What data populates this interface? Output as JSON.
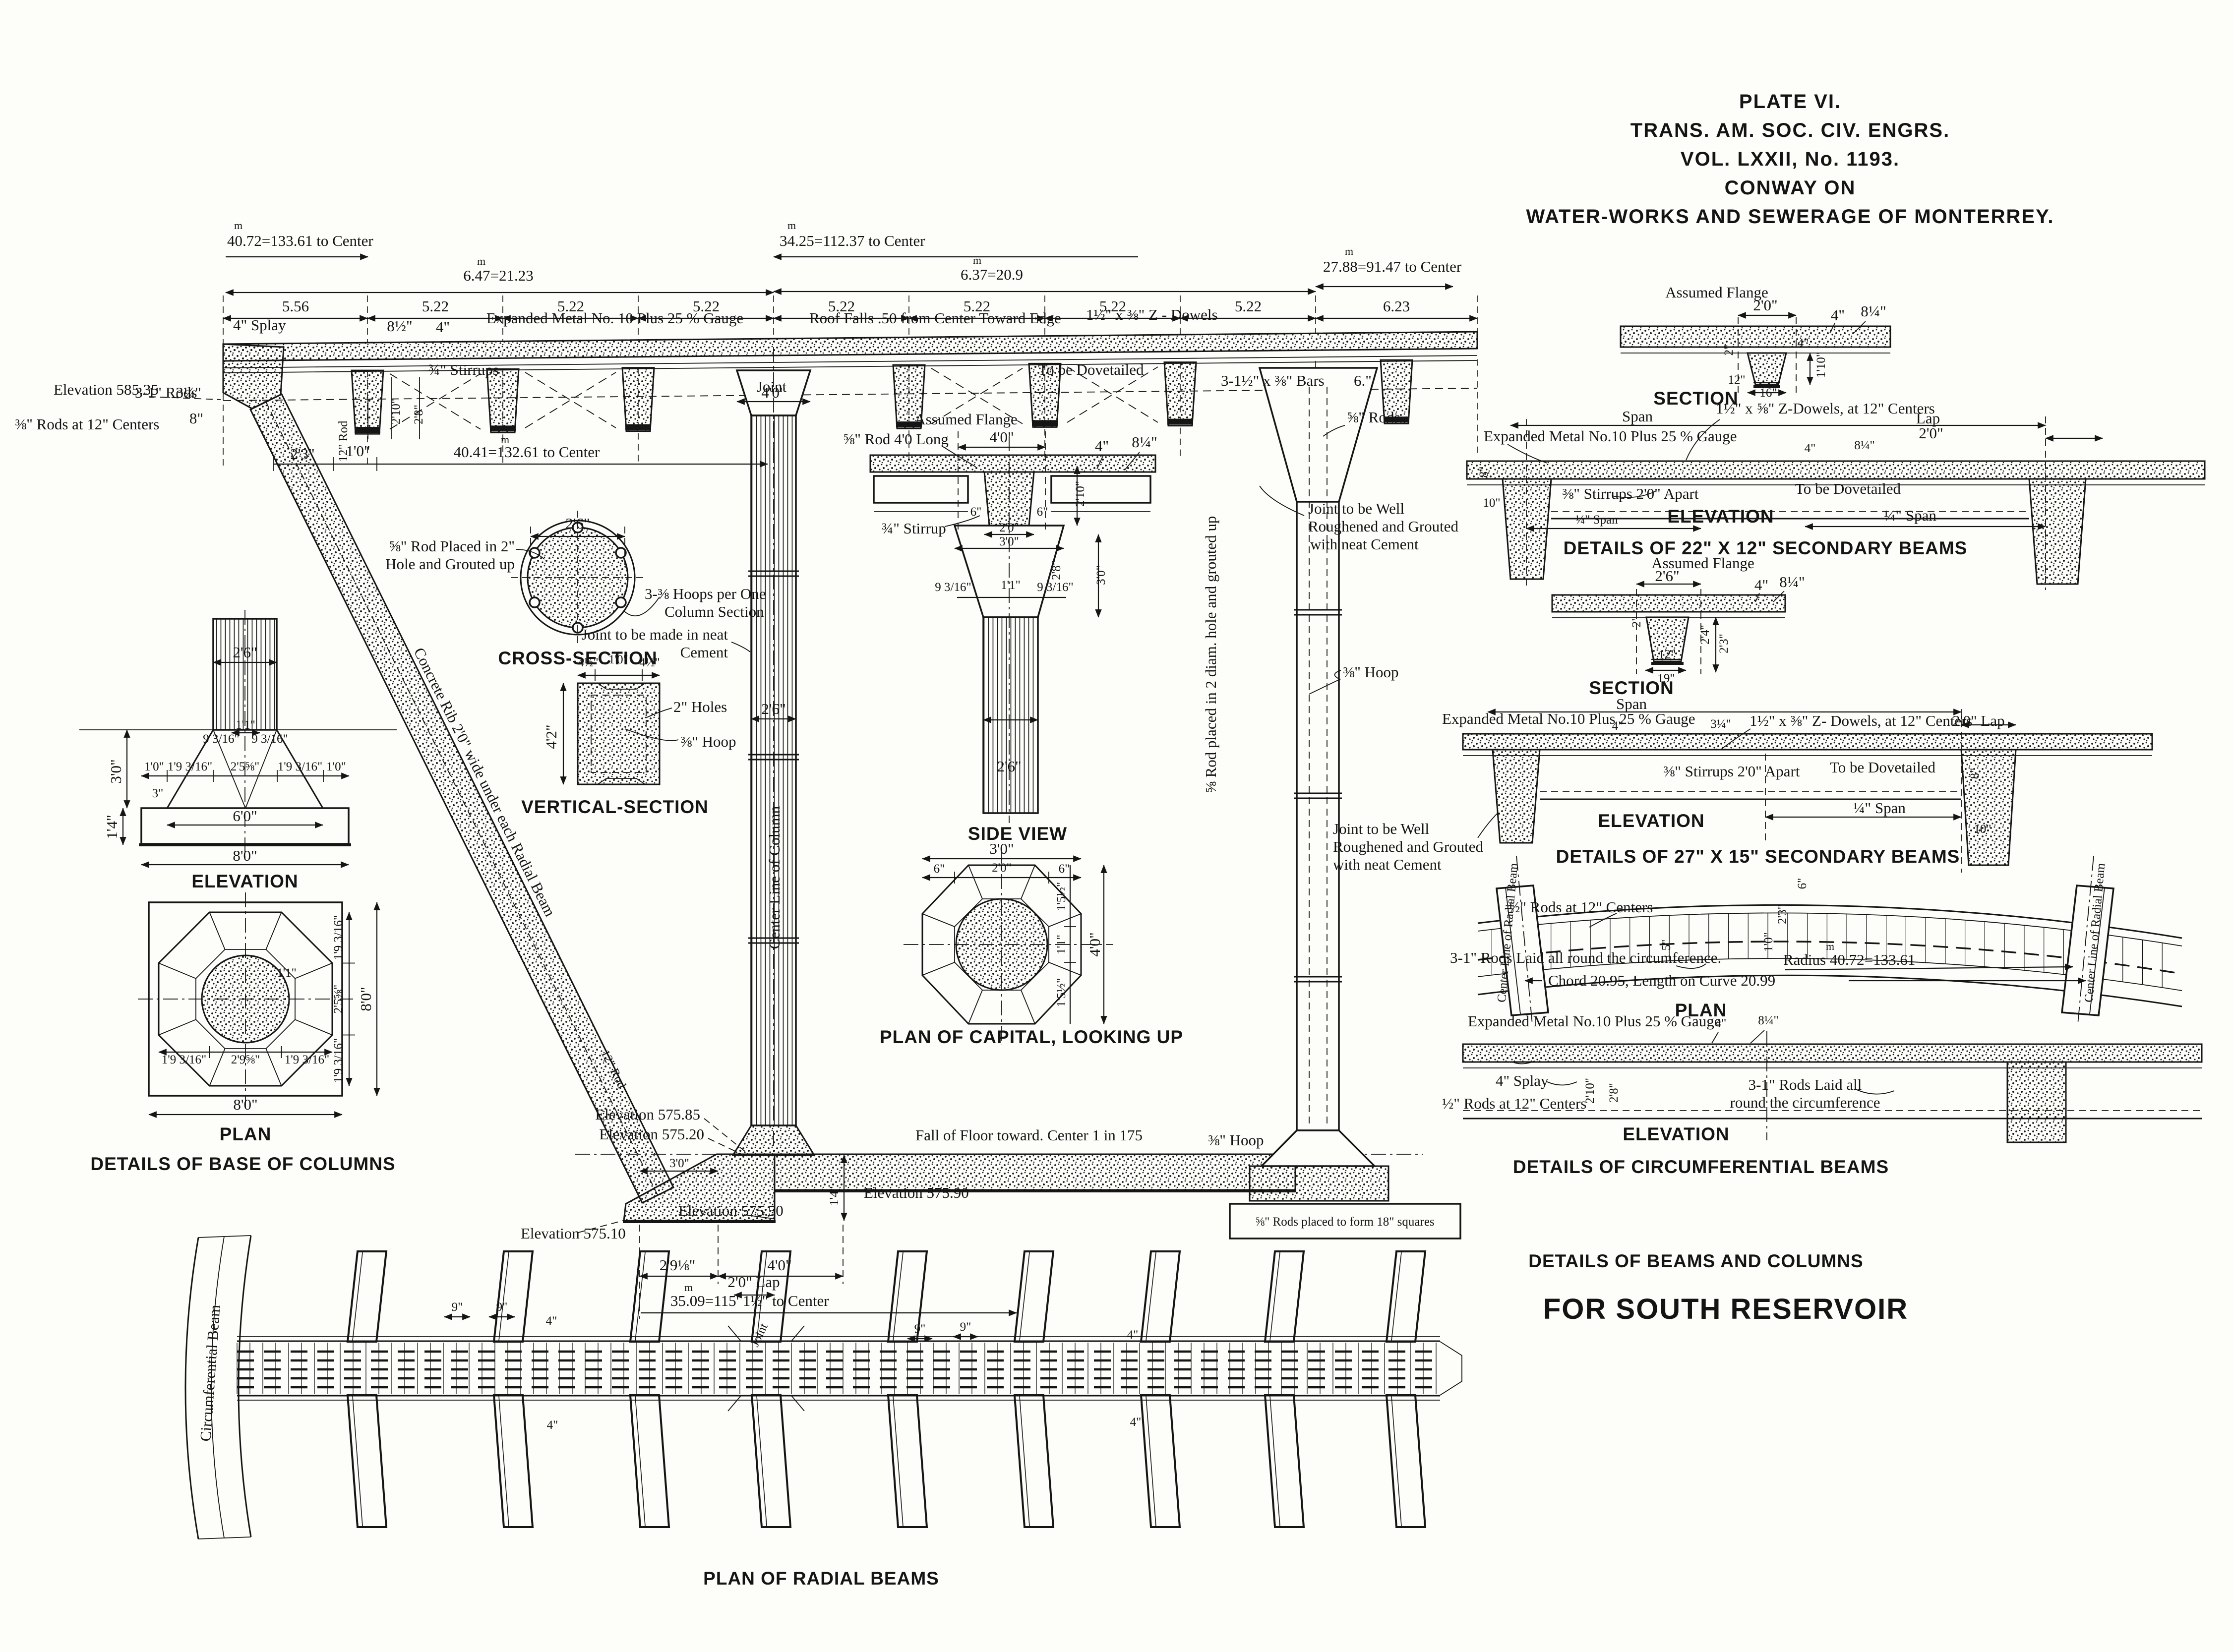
{
  "m": "m",
  "title": {
    "l1": "PLATE VI.",
    "l2": "TRANS. AM. SOC. CIV. ENGRS.",
    "l3": "VOL. LXXII, No. 1193.",
    "l4": "CONWAY ON",
    "l5": "WATER-WORKS AND SEWERAGE OF MONTERREY."
  },
  "roof": {
    "dim40": "40.72=133.61 to Center",
    "dim34": "34.25=112.37 to Center",
    "dim647": "6.47=21.23",
    "dim637": "6.37=20.9",
    "dim2788": "27.88=91.47 to Center",
    "seg": [
      "5.56",
      "5.22",
      "5.22",
      "5.22",
      "5.22",
      "5.22",
      "5.22",
      "5.22",
      "6.23"
    ],
    "splay": "4\" Splay",
    "d85": "8½\"",
    "d4": "4\"",
    "expanded": "Expanded Metal No. 10 Plus 25 % Gauge",
    "falls": "Roof Falls .50 from Center Toward Edge",
    "zdowels": "1½\" x ⅜\" Z - Dowels",
    "stirrups": "¾\" Stirrups",
    "joint": "Joint",
    "dovetail": "To be Dovetailed",
    "bars": "3-1½\" x ⅜\" Bars",
    "d6": "6.\"",
    "elev585": "Elevation 585.35",
    "rods12": "⅜\" Rods at 12\" Centers",
    "rods31": "3-1\" Rods",
    "dim4041": "40.41=132.61 to Center",
    "d23": "2'3\"",
    "d10": "1'0\"",
    "d8": "8\"",
    "d314": "3¼\"",
    "d210": "2'10\"",
    "d28": "2'8\"",
    "rib": "Concrete Rib 2'0\" wide under each Radial Beam",
    "rod12": "12\" Rod"
  },
  "col": {
    "d40": "4'0\"",
    "d26": "2'6\"",
    "cl": "Center Line of Column",
    "joint1": "Joint to be made in neat",
    "joint2": "Cement"
  },
  "base": {
    "d26": "2'6\"",
    "d30": "3'0\"",
    "d14": "1'4\"",
    "d11": "1'1\"",
    "d9316": "9 3/16\"",
    "d10": "1'0\"",
    "d19316": "1'9 3/16\"",
    "d2558": "2'5⅝\"",
    "d3": "3\"",
    "d60": "6'0\"",
    "d80": "8'0\"",
    "d2958": "2'9⅝\"",
    "elev": "ELEVATION",
    "plan": "PLAN",
    "caption": "DETAILS OF BASE OF COLUMNS"
  },
  "cs": {
    "d26": "2'6\"",
    "rod1": "⅝\" Rod Placed in 2\"",
    "rod2": "Hole and Grouted up",
    "hoops1": "3-⅜ Hoops per One",
    "hoops2": "Column Section",
    "caption": "CROSS-SECTION"
  },
  "vs": {
    "d45": "4½\"",
    "d10": "1'0\"",
    "d42": "4'2\"",
    "holes": "2\" Holes",
    "hoop": "⅜\" Hoop",
    "caption": "VERTICAL-SECTION"
  },
  "cap": {
    "flange": "Assumed Flange",
    "rod40": "⅝\" Rod 4'0 Long",
    "d40": "4'0\"",
    "d4": "4\"",
    "d814": "8¼\"",
    "d210": "2'10\"",
    "d6": "6\"",
    "stirrup": "¾\" Stirrup",
    "d20": "2'0\"",
    "d30": "3'0\"",
    "d28": "2'8\"",
    "d9316": "9 3/16\"",
    "d11": "1'1\"",
    "d26": "2'6\"",
    "side": "SIDE VIEW",
    "pd30": "3'0\"",
    "pd6": "6\"",
    "pd20": "2'0\"",
    "pd155": "1'5½\"",
    "pd11": "1'1\"",
    "pd40": "4'0\"",
    "plancap": "PLAN OF CAPITAL, LOOKING UP"
  },
  "rc": {
    "grout": "⅝ Rod placed in 2 diam. hole and grouted up",
    "rods": "⅝\" Rods",
    "hoop": "⅜\" Hoop",
    "joint1": "Joint to be Well",
    "joint2": "Roughened and Grouted",
    "joint3": "with neat Cement",
    "squares": "⅝\" Rods placed to form 18\" squares"
  },
  "b22": {
    "flange": "Assumed Flange",
    "d20": "2'0\"",
    "d4": "4\"",
    "d814": "8¼\"",
    "d2": "2\"",
    "d110": "1'10\"",
    "d12": "12\"",
    "d16": "16\"",
    "sec": "SECTION",
    "span": "Span",
    "zdowels": "1½\" x ⅝\" Z-Dowels, at 12\" Centers",
    "lap": "Lap",
    "expanded": "Expanded Metal No.10 Plus 25 % Gauge",
    "stirrups": "⅜\" Stirrups 2'0\" Apart",
    "dovetail": "To be Dovetailed",
    "d8": "8\"",
    "d10in": "10\"",
    "qspan": "¼\" Span",
    "elev": "ELEVATION",
    "caption": "DETAILS OF 22\" X 12\" SECONDARY BEAMS"
  },
  "b27": {
    "flange": "Assumed Flange",
    "d26": "2'6\"",
    "d4": "4\"",
    "d814": "8¼\"",
    "d2": "2\"",
    "d24": "2'4\"",
    "d23": "2'3\"",
    "d12": "12\"",
    "d19": "19\"",
    "sec": "SECTION",
    "span": "Span",
    "expanded": "Expanded Metal No.10 Plus 25 % Gauge",
    "d314": "3¼\"",
    "zdowels": "1½\" x ⅜\" Z- Dowels, at 12\" Centers",
    "lap": "2'0\" Lap",
    "stirrups": "⅜\" Stirrups 2'0\" Apart",
    "dovetail": "To be Dovetailed",
    "d8": "8\"",
    "d10in": "10\"",
    "qspan": "¼\" Span",
    "elev": "ELEVATION",
    "caption": "DETAILS OF 27\" X 15\" SECONDARY BEAMS",
    "joint1": "Joint to be Well",
    "joint2": "Roughened and Grouted",
    "joint3": "with neat Cement"
  },
  "circ": {
    "cl": "Center Line of Radial Beam",
    "rodshalf": "½\" Rods at 12\" Centers",
    "rods31": "3-1\" Rods Laid all  round the circumference.",
    "radius": "Radius 40.72=133.61",
    "chord": "Chord 20.95, Length on Curve 20.99",
    "d5": "5\"",
    "d23": "2'3\"",
    "d10": "1'0\"",
    "d6": "6\"",
    "plan": "PLAN",
    "expanded": "Expanded Metal No.10 Plus 25 % Gauge",
    "d4": "4\"",
    "d814": "8¼\"",
    "splay": "4\" Splay",
    "rods12": "½\" Rods at 12\" Centers",
    "d210": "2'10\"",
    "d28": "2'8\"",
    "laid1": "3-1\" Rods Laid all",
    "laid2": "round the circumference",
    "elev": "ELEVATION",
    "caption": "DETAILS OF CIRCUMFERENTIAL BEAMS"
  },
  "fl": {
    "fall": "Fall of Floor toward.  Center 1 in 175",
    "e85": "Elevation 575.85",
    "e20": "Elevation 575.20",
    "e90": "Elevation 575.90",
    "e50": "Elevation 575.50",
    "e10": "Elevation 575.10",
    "d30": "3'0\"",
    "d14": "1'4\"",
    "d2918": "2'9⅛\"",
    "d40": "4'0\"",
    "dim3509": "35.09=115' 1½\" to Center"
  },
  "rad": {
    "circbeam": "Circumferential Beam",
    "lap": "2'0\" Lap",
    "joint": "Joint",
    "d9": "9\"",
    "d4": "4\"",
    "caption": "PLAN OF RADIAL BEAMS"
  },
  "footer": {
    "l1": "DETAILS OF BEAMS AND COLUMNS",
    "l2": "FOR SOUTH RESERVOIR"
  }
}
